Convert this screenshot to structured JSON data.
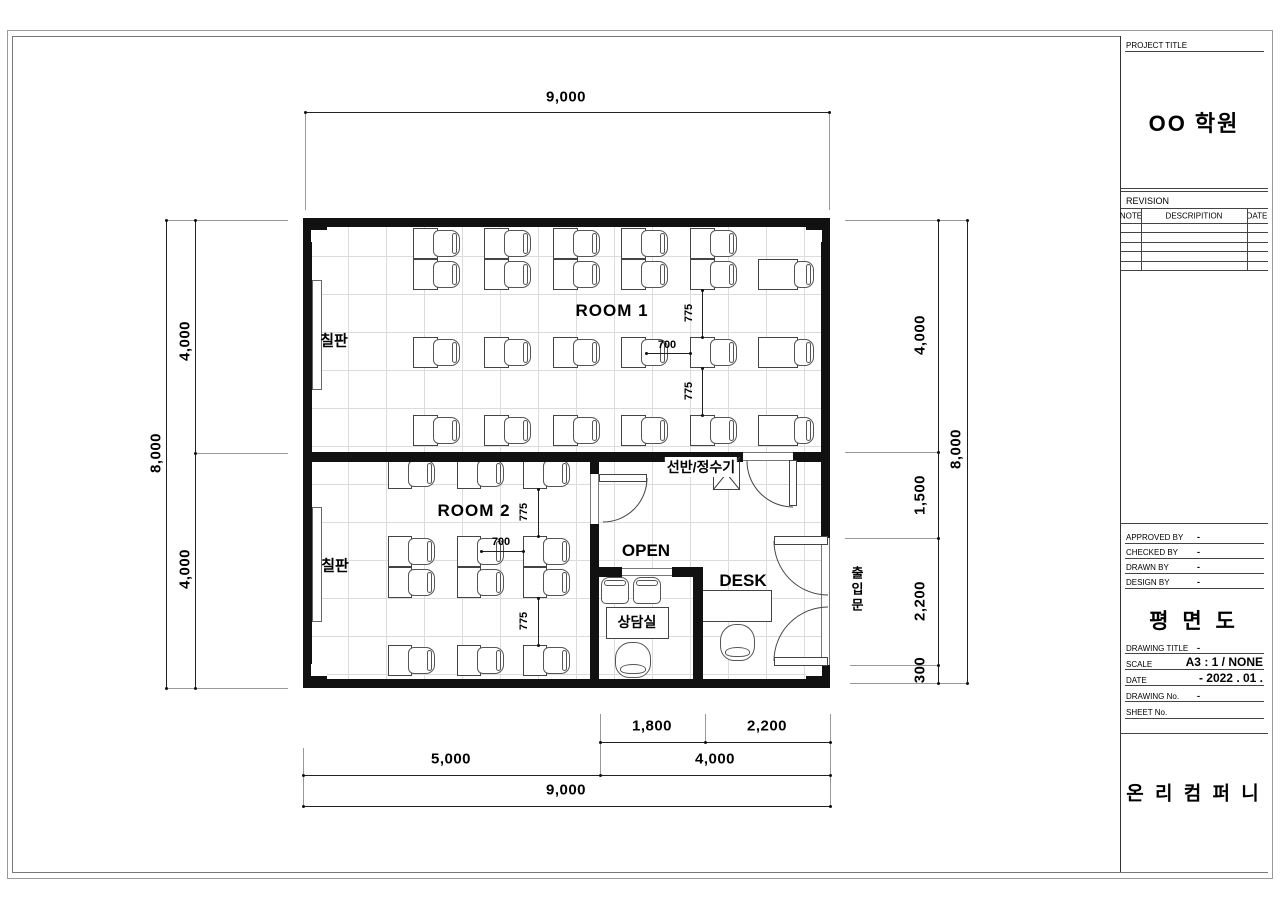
{
  "colors": {
    "wall": "#111111",
    "line": "#222222",
    "grid": "#dcdcdc",
    "text": "#000000"
  },
  "title_block": {
    "project_title_label": "PROJECT TITLE",
    "project_name": "OO 학원",
    "revision_label": "REVISION",
    "rev_col_note": "NOTE",
    "rev_col_desc": "DESCRIPITION",
    "rev_col_date": "DATE",
    "approved_label": "APPROVED BY",
    "approved_value": "-",
    "checked_label": "CHECKED BY",
    "checked_value": "-",
    "drawn_label": "DRAWN BY",
    "drawn_value": "-",
    "design_label": "DESIGN BY",
    "design_value": "-",
    "drawing_name": "평 면 도",
    "drawing_title_label": "DRAWING TITLE",
    "drawing_title_value": "-",
    "scale_label": "SCALE",
    "scale_value": "A3 :  1 / NONE",
    "date_label": "DATE",
    "date_value": "-  2022 . 01 .",
    "drawing_no_label": "DRAWING No.",
    "drawing_no_value": "-",
    "sheet_no_label": "SHEET No.",
    "company": "온 리 컴 퍼 니"
  },
  "plan": {
    "room1_label": "ROOM 1",
    "room2_label": "ROOM 2",
    "blackboard1_label": "칠판",
    "blackboard2_label": "칠판",
    "shelf_label": "선반/정수기",
    "open_label": "OPEN",
    "desk_label": "DESK",
    "counseling_label": "상담실",
    "entrance_label": "출입문",
    "dims": {
      "top_9000": "9,000",
      "left_8000": "8,000",
      "left_4000a": "4,000",
      "left_4000b": "4,000",
      "right_8000": "8,000",
      "right_4000": "4,000",
      "right_1500": "1,500",
      "right_2200": "2,200",
      "right_300": "300",
      "bottom_1800": "1,800",
      "bottom_2200": "2,200",
      "bottom_5000": "5,000",
      "bottom_4000": "4,000",
      "bottom_9000": "9,000",
      "r1_775a": "775",
      "r1_700": "700",
      "r1_775b": "775",
      "r2_775a": "775",
      "r2_700": "700",
      "r2_775b": "775"
    }
  }
}
